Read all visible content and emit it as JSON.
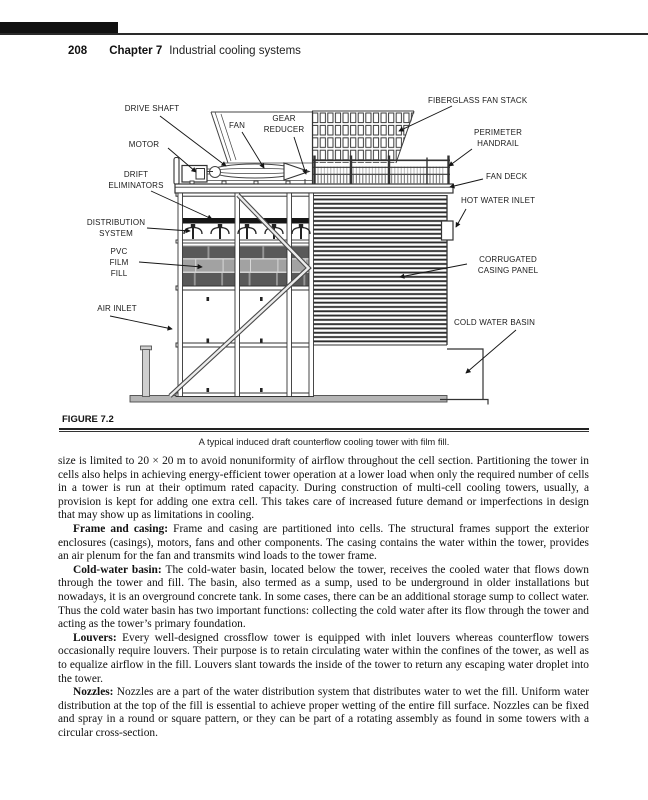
{
  "header": {
    "page_number": "208",
    "chapter_label": "Chapter 7",
    "chapter_title": "Industrial cooling systems"
  },
  "figure": {
    "label": "FIGURE 7.2",
    "caption": "A typical induced draft counterflow cooling tower with film fill.",
    "diagram_labels": {
      "drive_shaft": "DRIVE SHAFT",
      "fan": "FAN",
      "gear_reducer": "GEAR\nREDUCER",
      "motor": "MOTOR",
      "drift_eliminators": "DRIFT\nELIMINATORS",
      "distribution_system": "DISTRIBUTION\nSYSTEM",
      "pvc_film_fill": "PVC\nFILM\nFILL",
      "air_inlet": "AIR INLET",
      "fiberglass_fan_stack": "FIBERGLASS FAN STACK",
      "perimeter_handrail": "PERIMETER\nHANDRAIL",
      "fan_deck": "FAN DECK",
      "hot_water_inlet": "HOT WATER INLET",
      "corrugated_casing_panel": "CORRUGATED\nCASING PANEL",
      "cold_water_basin": "COLD WATER BASIN"
    }
  },
  "body": {
    "paragraphs": [
      {
        "lead": "",
        "text": "size is limited to 20 × 20 m to avoid nonuniformity of airflow throughout the cell section. Partitioning the tower in cells also helps in achieving energy-efficient tower operation at a lower load when only the required number of cells in a tower is run at their optimum rated capacity. During construction of multi-cell cooling towers, usually, a provision is kept for adding one extra cell. This takes care of increased future demand or imperfections in design that may show up as limitations in cooling."
      },
      {
        "lead": "Frame and casing:",
        "text": " Frame and casing are partitioned into cells. The structural frames support the exterior enclosures (casings), motors, fans and other components. The casing contains the water within the tower, provides an air plenum for the fan and transmits wind loads to the tower frame."
      },
      {
        "lead": "Cold-water basin:",
        "text": " The cold-water basin, located below the tower, receives the cooled water that flows down through the tower and fill. The basin, also termed as a sump, used to be underground in older installations but nowadays, it is an overground concrete tank. In some cases, there can be an additional storage sump to collect water. Thus the cold water basin has two important functions: collecting the cold water after its flow through the tower and acting as the tower’s primary foundation."
      },
      {
        "lead": "Louvers:",
        "text": " Every well-designed crossflow tower is equipped with inlet louvers whereas counterflow towers occasionally require louvers. Their purpose is to retain circulating water within the confines of the tower, as well as to equalize airflow in the fill. Louvers slant towards the inside of the tower to return any escaping water droplet into the tower."
      },
      {
        "lead": "Nozzles:",
        "text": " Nozzles are a part of the water distribution system that distributes water to wet the fill. Uniform water distribution at the top of the fill is essential to achieve proper wetting of the entire fill surface. Nozzles can be fixed and spray in a round or square pattern, or they can be part of a rotating assembly as found in some towers with a circular cross-section."
      }
    ]
  },
  "colors": {
    "ink": "#1b1b1b",
    "line": "#333333",
    "brick": "#595959",
    "fill_bed": "#a2a2a2",
    "slab": "#b5b5b5",
    "drift_band": "#161616"
  }
}
